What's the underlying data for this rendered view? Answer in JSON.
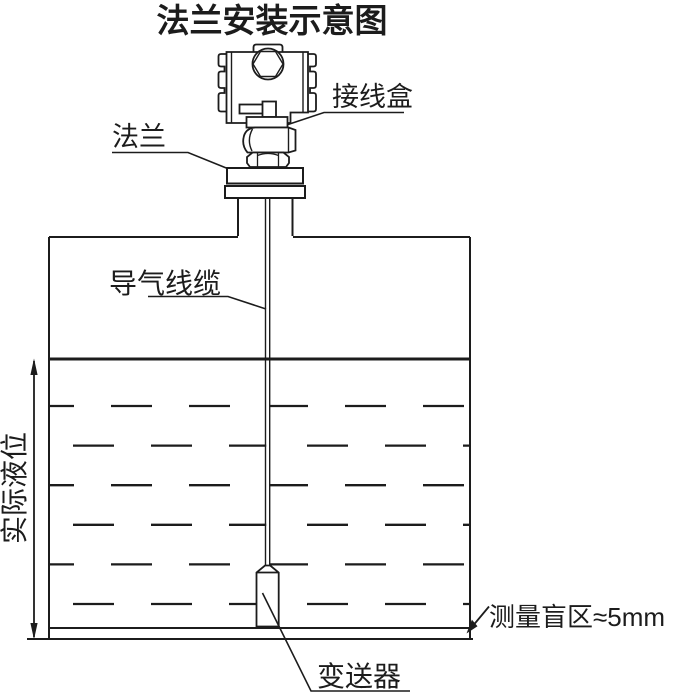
{
  "diagram": {
    "title": "法兰安装示意图",
    "labels": {
      "junction_box": "接线盒",
      "flange": "法兰",
      "air_cable": "导气线缆",
      "actual_level": "实际液位",
      "transmitter": "变送器",
      "blind_zone": "测量盲区≈5mm"
    },
    "colors": {
      "line": "#1c1c1c",
      "background": "#ffffff"
    }
  }
}
